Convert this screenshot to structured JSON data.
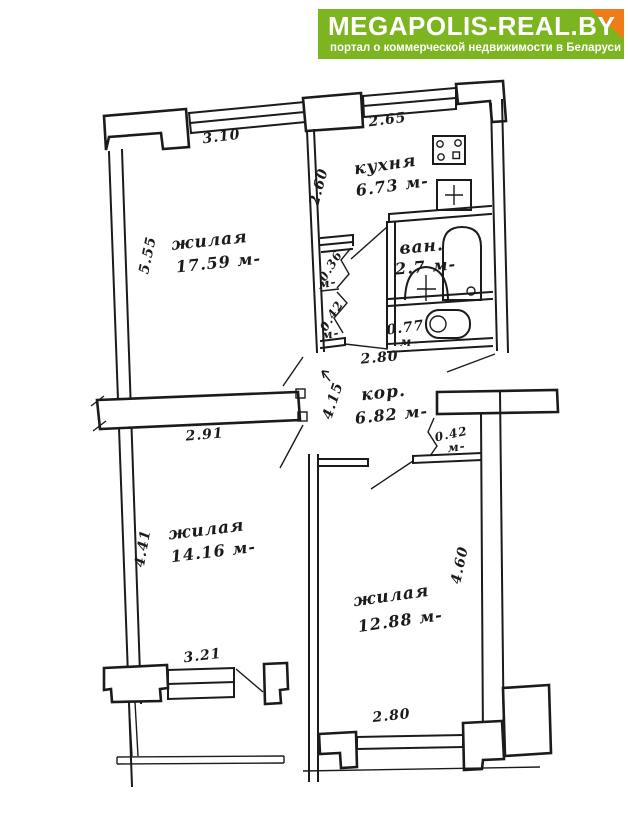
{
  "header": {
    "logo_title": "MEGAPOLIS-REAL.BY",
    "logo_subtitle": "портал о коммерческой недвижимости в Беларуси",
    "colors": {
      "green": "#7cb520",
      "orange": "#ef7d17",
      "text": "#ffffff"
    }
  },
  "plan": {
    "kind": "apartment-floor-plan",
    "ink_color": "#1b1b1b",
    "units": "м",
    "rooms": {
      "living1": {
        "name": "жилая",
        "area_label": "17.59 м-"
      },
      "kitchen": {
        "name": "кухня",
        "area_label": "6.73 м-"
      },
      "bath": {
        "name": "ван.",
        "area_label": "2.7 м-"
      },
      "wc": {
        "value": "0.77",
        "unit": "м-"
      },
      "corridor": {
        "name": "кор.",
        "area_label": "6.82 м-"
      },
      "living2": {
        "name": "жилая",
        "area_label": "14.16 м-"
      },
      "living3": {
        "name": "жилая",
        "area_label": "12.88 м-"
      },
      "closet_top": {
        "value": "0.36",
        "unit": "м-"
      },
      "closet_bottom": {
        "value": "0.42",
        "unit": "м-"
      },
      "closet_right": {
        "value": "0.42",
        "unit": "м-"
      }
    },
    "dims": {
      "ul_window": "3.10",
      "ul_height": "5.55",
      "kitchen_window": "2.65",
      "kitchen_depth": "2.60",
      "hall_width": "2.80",
      "hall_length": "4.15",
      "ll_top": "2.91",
      "ll_height": "4.41",
      "ll_window": "3.21",
      "lr_height": "4.60",
      "lr_window": "2.80"
    }
  }
}
